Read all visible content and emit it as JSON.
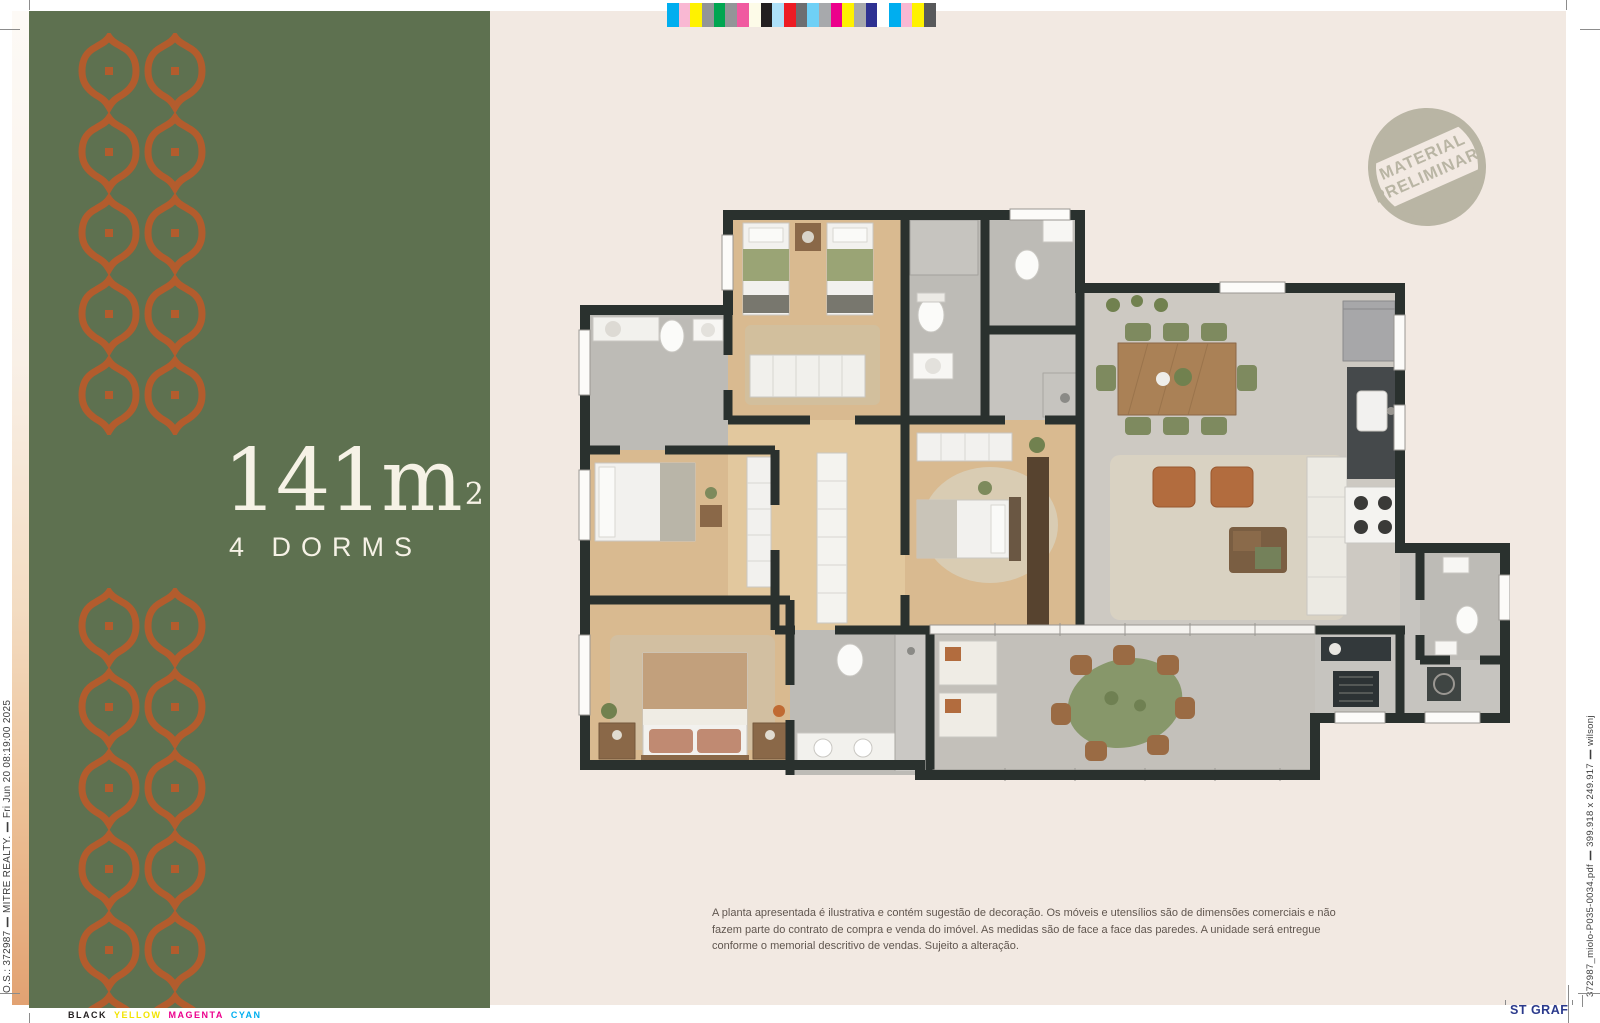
{
  "theme": {
    "sidebar_green": "#5e7150",
    "pattern_orange": "#b35c2d",
    "sheet_cream": "#f2e9e2",
    "headline_cream": "#f6f2e6",
    "wall_dark": "#2a312e",
    "stamp_gray": "#b9b5a4",
    "printer_blue": "#2b3a8c"
  },
  "sidebar": {
    "area_number": "141m",
    "area_sup": "2",
    "dorms_label": "4 DORMS",
    "pattern": {
      "cols": 2,
      "top_rows": 5,
      "bottom_rows": 6,
      "cell_w": 66,
      "pitch_y": 81,
      "motif_h": 78
    }
  },
  "stamp": {
    "line1": "MATERIAL",
    "line2": "PRELIMINAR*"
  },
  "disclaimer": {
    "text": "A planta apresentada é ilustrativa e contém sugestão de decoração. Os móveis e utensílios são de dimensões comerciais e não fazem parte do contrato de compra e venda do imóvel. As medidas são de face a face das paredes. A unidade será entregue conforme o memorial descritivo de vendas. Sujeito a alteração."
  },
  "print_marks": {
    "left_slug": "O.S.: 372987 ❙ MITRE REALTY. ❙ Fri Jun 20 08:19:00 2025",
    "right_slug": "372987_miolo-P035-0034.pdf ❙ 399.918 x 249.917 ❙ wilsonj",
    "printer_label": "ST GRAF",
    "color_words": [
      {
        "label": "BLACK",
        "color": "#231f20"
      },
      {
        "label": "YELLOW",
        "color": "#f2e400"
      },
      {
        "label": "MAGENTA",
        "color": "#ec008c"
      },
      {
        "label": "CYAN",
        "color": "#00aeef"
      }
    ],
    "color_bar": [
      "#00aeef",
      "#f9b8d3",
      "#fff200",
      "#939598",
      "#00a651",
      "#939598",
      "#f05aa0",
      "#fdfbe8",
      "#231f20",
      "#aee0f8",
      "#ed1c24",
      "#6d6e71",
      "#6fd0f6",
      "#a7a9ac",
      "#ec008c",
      "#fff200",
      "#a7a9ac",
      "#2e3192",
      "#ffffff",
      "#00aeef",
      "#f9b8d3",
      "#fff200",
      "#58595b"
    ]
  }
}
